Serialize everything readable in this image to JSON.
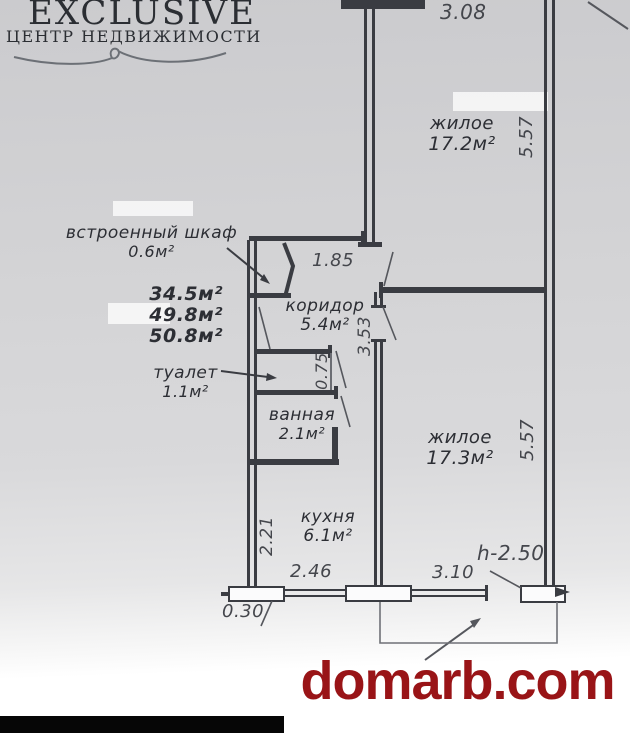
{
  "logo": {
    "title": "EXCLUSIVE",
    "subtitle": "ЦЕНТР НЕДВИЖИМОСТИ"
  },
  "watermark": {
    "text": "domarb.com"
  },
  "plan": {
    "rooms": {
      "living_top": {
        "label": "жилое",
        "area": "17.2м²"
      },
      "closet": {
        "label": "встроенный шкаф",
        "area": "0.6м²"
      },
      "corridor": {
        "label": "коридор",
        "area": "5.4м²"
      },
      "toilet": {
        "label": "туалет",
        "area": "1.1м²"
      },
      "bathroom": {
        "label": "ванная",
        "area": "2.1м²"
      },
      "kitchen": {
        "label": "кухня",
        "area": "6.1м²"
      },
      "living_bottom": {
        "label": "жилое",
        "area": "17.3м²"
      }
    },
    "area_summary": [
      "34.5м²",
      "49.8м²",
      "50.8м²"
    ],
    "dims": {
      "top_width": "3.08",
      "living_top_height": "5.57",
      "closet_width": "1.85",
      "corridor_height": "3.53",
      "toilet_width": "0.75",
      "living_bottom_height": "5.57",
      "kitchen_height": "2.21",
      "kitchen_width": "2.46",
      "living_bottom_width": "3.10",
      "wall_offset": "0.30",
      "ceiling_height": "h-2.50"
    }
  },
  "colors": {
    "ink": "#3a3c42",
    "dim_text": "#44464c",
    "watermark_red": "#991417",
    "paper": "#d3d3d5"
  }
}
